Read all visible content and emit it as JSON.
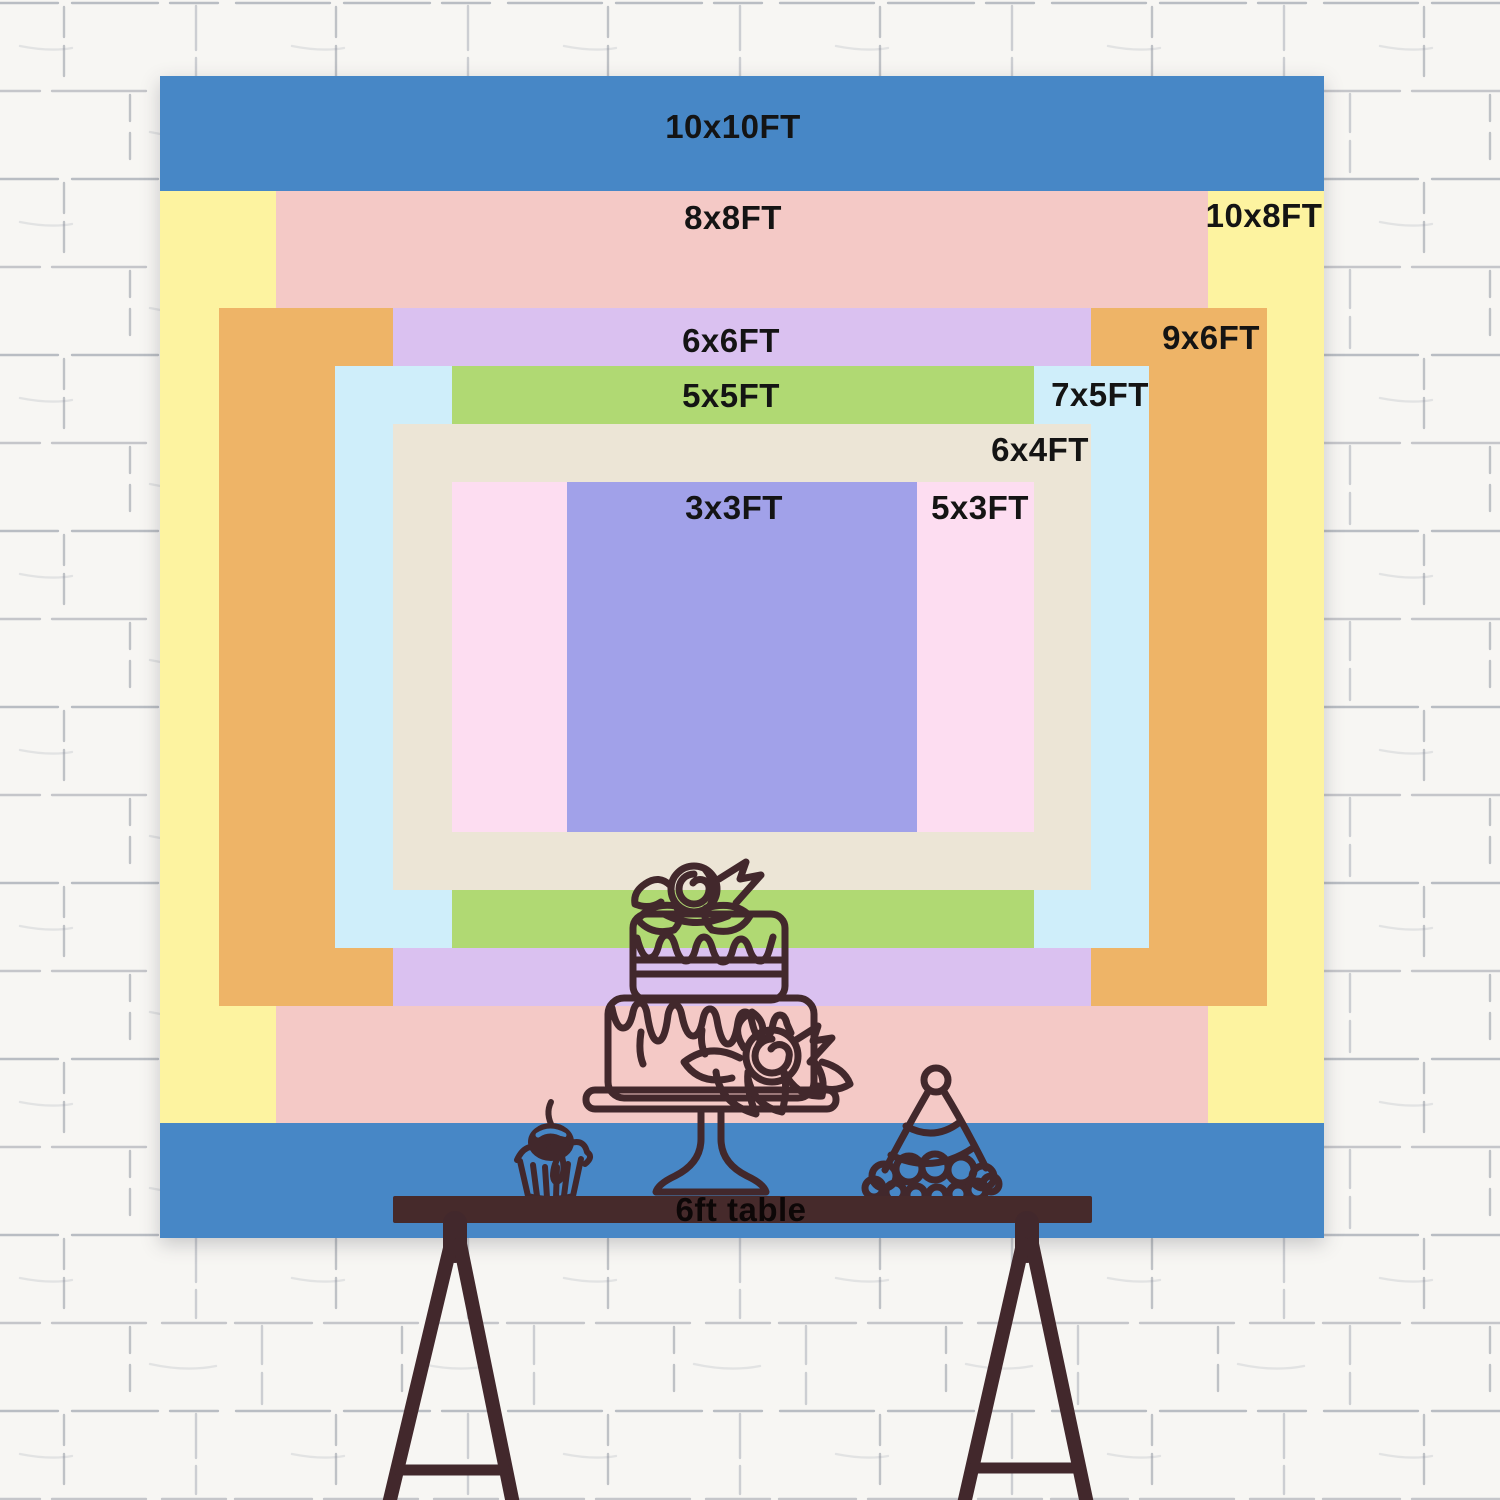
{
  "title": "Backdrop size comparison chart",
  "sizes": [
    {
      "label": "10x10FT",
      "width_ft": 10,
      "height_ft": 10,
      "color": "#4787c6"
    },
    {
      "label": "10x8FT",
      "width_ft": 10,
      "height_ft": 8,
      "color": "#fdf3a0"
    },
    {
      "label": "8x8FT",
      "width_ft": 8,
      "height_ft": 8,
      "color": "#f4c9c6"
    },
    {
      "label": "9x6FT",
      "width_ft": 9,
      "height_ft": 6,
      "color": "#eeb467"
    },
    {
      "label": "6x6FT",
      "width_ft": 6,
      "height_ft": 6,
      "color": "#dac1f0"
    },
    {
      "label": "7x5FT",
      "width_ft": 7,
      "height_ft": 5,
      "color": "#cfeefa"
    },
    {
      "label": "5x5FT",
      "width_ft": 5,
      "height_ft": 5,
      "color": "#b0d973"
    },
    {
      "label": "6x4FT",
      "width_ft": 6,
      "height_ft": 4,
      "color": "#ece5d6"
    },
    {
      "label": "5x3FT",
      "width_ft": 5,
      "height_ft": 3,
      "color": "#fdddf1"
    },
    {
      "label": "3x3FT",
      "width_ft": 3,
      "height_ft": 3,
      "color": "#a1a1e9"
    }
  ],
  "table": {
    "label": "6ft table",
    "length_ft": 6,
    "bar_color": "#462a2b"
  },
  "illustration": {
    "line_color": "#42282c",
    "items": [
      "two-tier-cake",
      "cupcake-with-cherry",
      "party-hat",
      "trestle-table"
    ]
  },
  "wall": {
    "base_color": "#f7f6f3",
    "mortar_color": "#878d9a"
  }
}
